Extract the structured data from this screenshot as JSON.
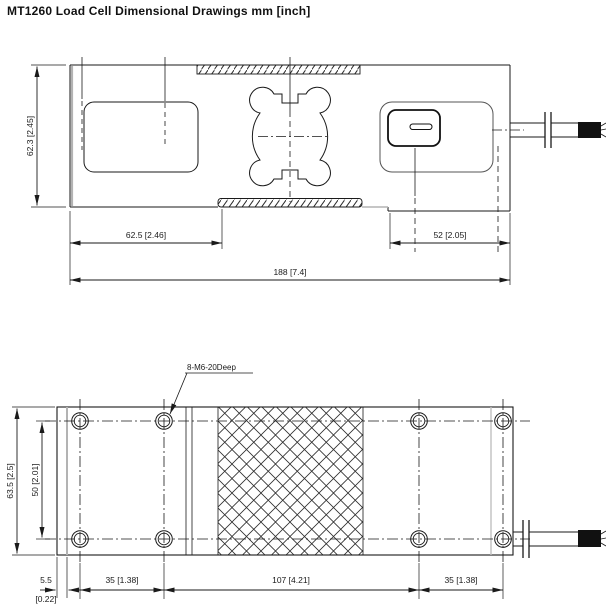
{
  "title": "MT1260 Load Cell Dimensional Drawings mm [inch]",
  "side_view": {
    "dim_height": "62.3 [2.45]",
    "dim_left_section": "62.5 [2.46]",
    "dim_right_section": "52 [2.05]",
    "dim_overall_length": "188 [7.4]"
  },
  "plan_view": {
    "thread_callout": "8-M6-20Deep",
    "dim_overall_width": "63.5 [2.5]",
    "dim_hole_span_width": "50 [2.01]",
    "dim_edge_offset_mm": "5.5",
    "dim_edge_offset_inch": "[0.22]",
    "dim_hole_pitch_left": "35 [1.38]",
    "dim_center_span": "107 [4.21]",
    "dim_hole_pitch_right": "35 [1.38]"
  },
  "colors": {
    "line": "#1a1a1a",
    "accent_gray": "#b3b3b3",
    "cable_black": "#111111",
    "background": "#ffffff"
  }
}
